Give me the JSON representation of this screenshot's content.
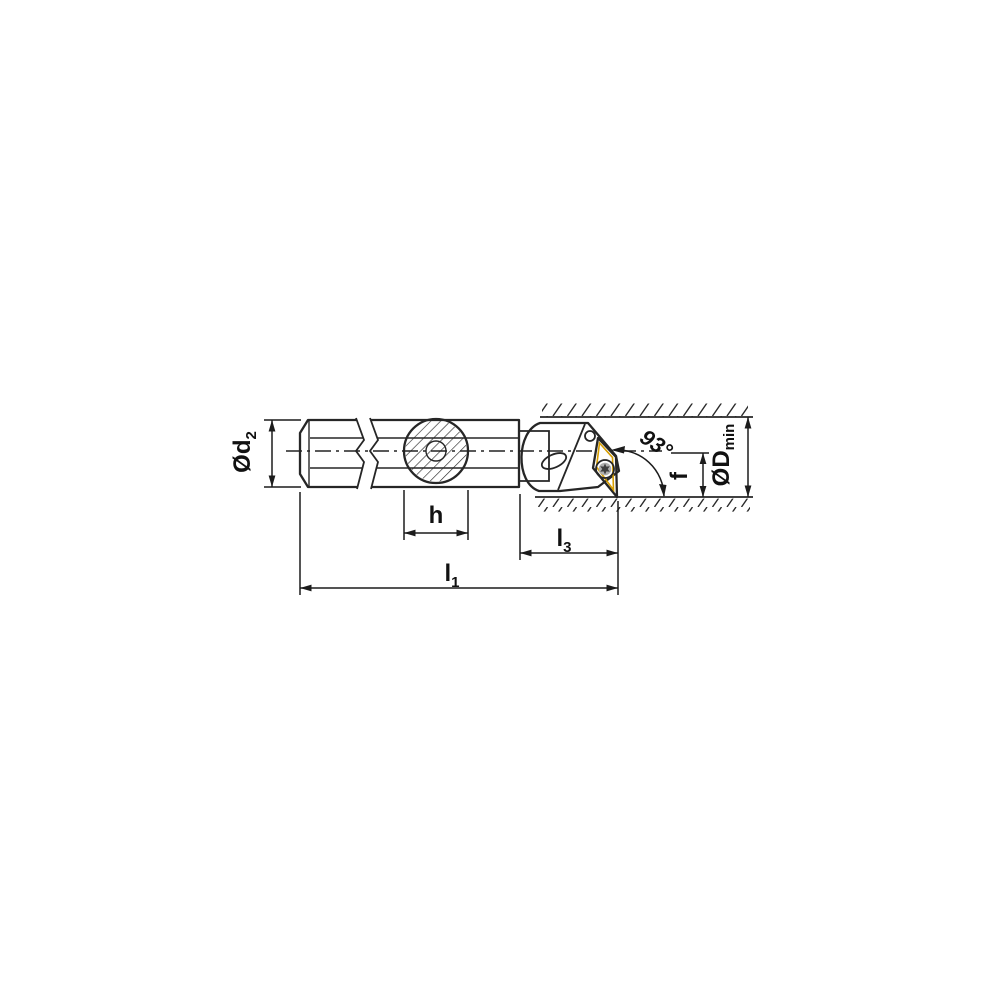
{
  "page": {
    "background_color": "#ffffff"
  },
  "drawing": {
    "kind": "technical dimension drawing - internal boring bar with indexable 35-degree insert, 93-degree approach angle, shown inside a bored workpiece",
    "colors": {
      "body_fill": "#c9cacb",
      "outline": "#262626",
      "insert_fill": "#f6c60d",
      "insert_bevel": "#d79e00",
      "screw_fill": "#c6c7c8",
      "screw_star": "#3f3f3f",
      "hole_fill": "#cdced0",
      "slot_fill": "#eef0f0",
      "background": "#ffffff"
    },
    "labels": {
      "shank_diameter": {
        "base": "Ød",
        "sub": "2"
      },
      "boss_width": {
        "base": "h",
        "sub": ""
      },
      "head_length": {
        "base": "l",
        "sub": "3"
      },
      "overall_length": {
        "base": "l",
        "sub": "1"
      },
      "approach_angle": {
        "base": "93°",
        "sub": ""
      },
      "tip_offset": {
        "base": "f",
        "sub": ""
      },
      "min_bore_diameter": {
        "base": "ØD",
        "sub": "min"
      }
    }
  }
}
